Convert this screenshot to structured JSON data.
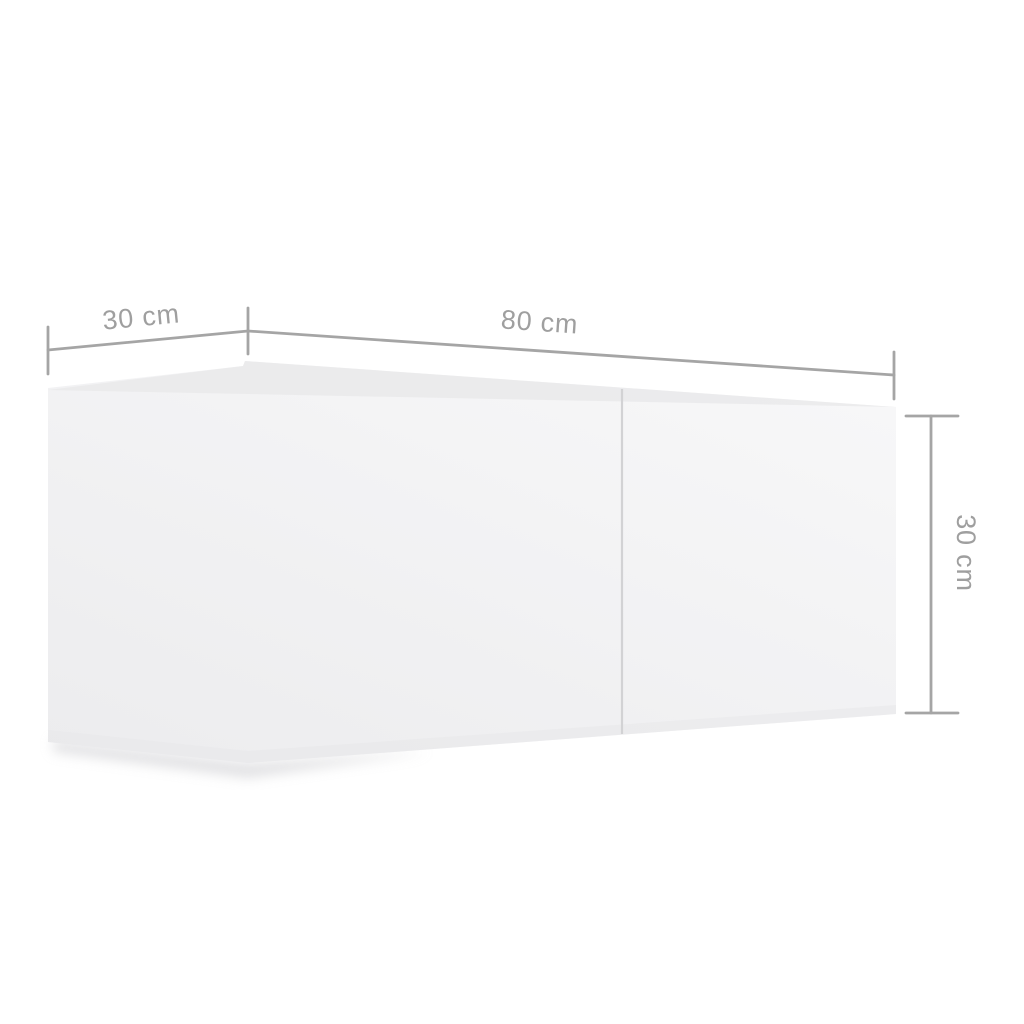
{
  "diagram": {
    "labels": {
      "depth": "30 cm",
      "width": "80 cm",
      "height": "30 cm"
    },
    "colors": {
      "background": "#ffffff",
      "dimension_line": "#a5a5a5",
      "label_text": "#9f9f9f",
      "face_light": "#f7f7f8",
      "face_dark": "#ececee",
      "top_face": "#e8e8ea",
      "bottom_shade": "#e7e7e9",
      "divider": "#d2d2d4",
      "shadow": "#c9c9cd"
    }
  }
}
